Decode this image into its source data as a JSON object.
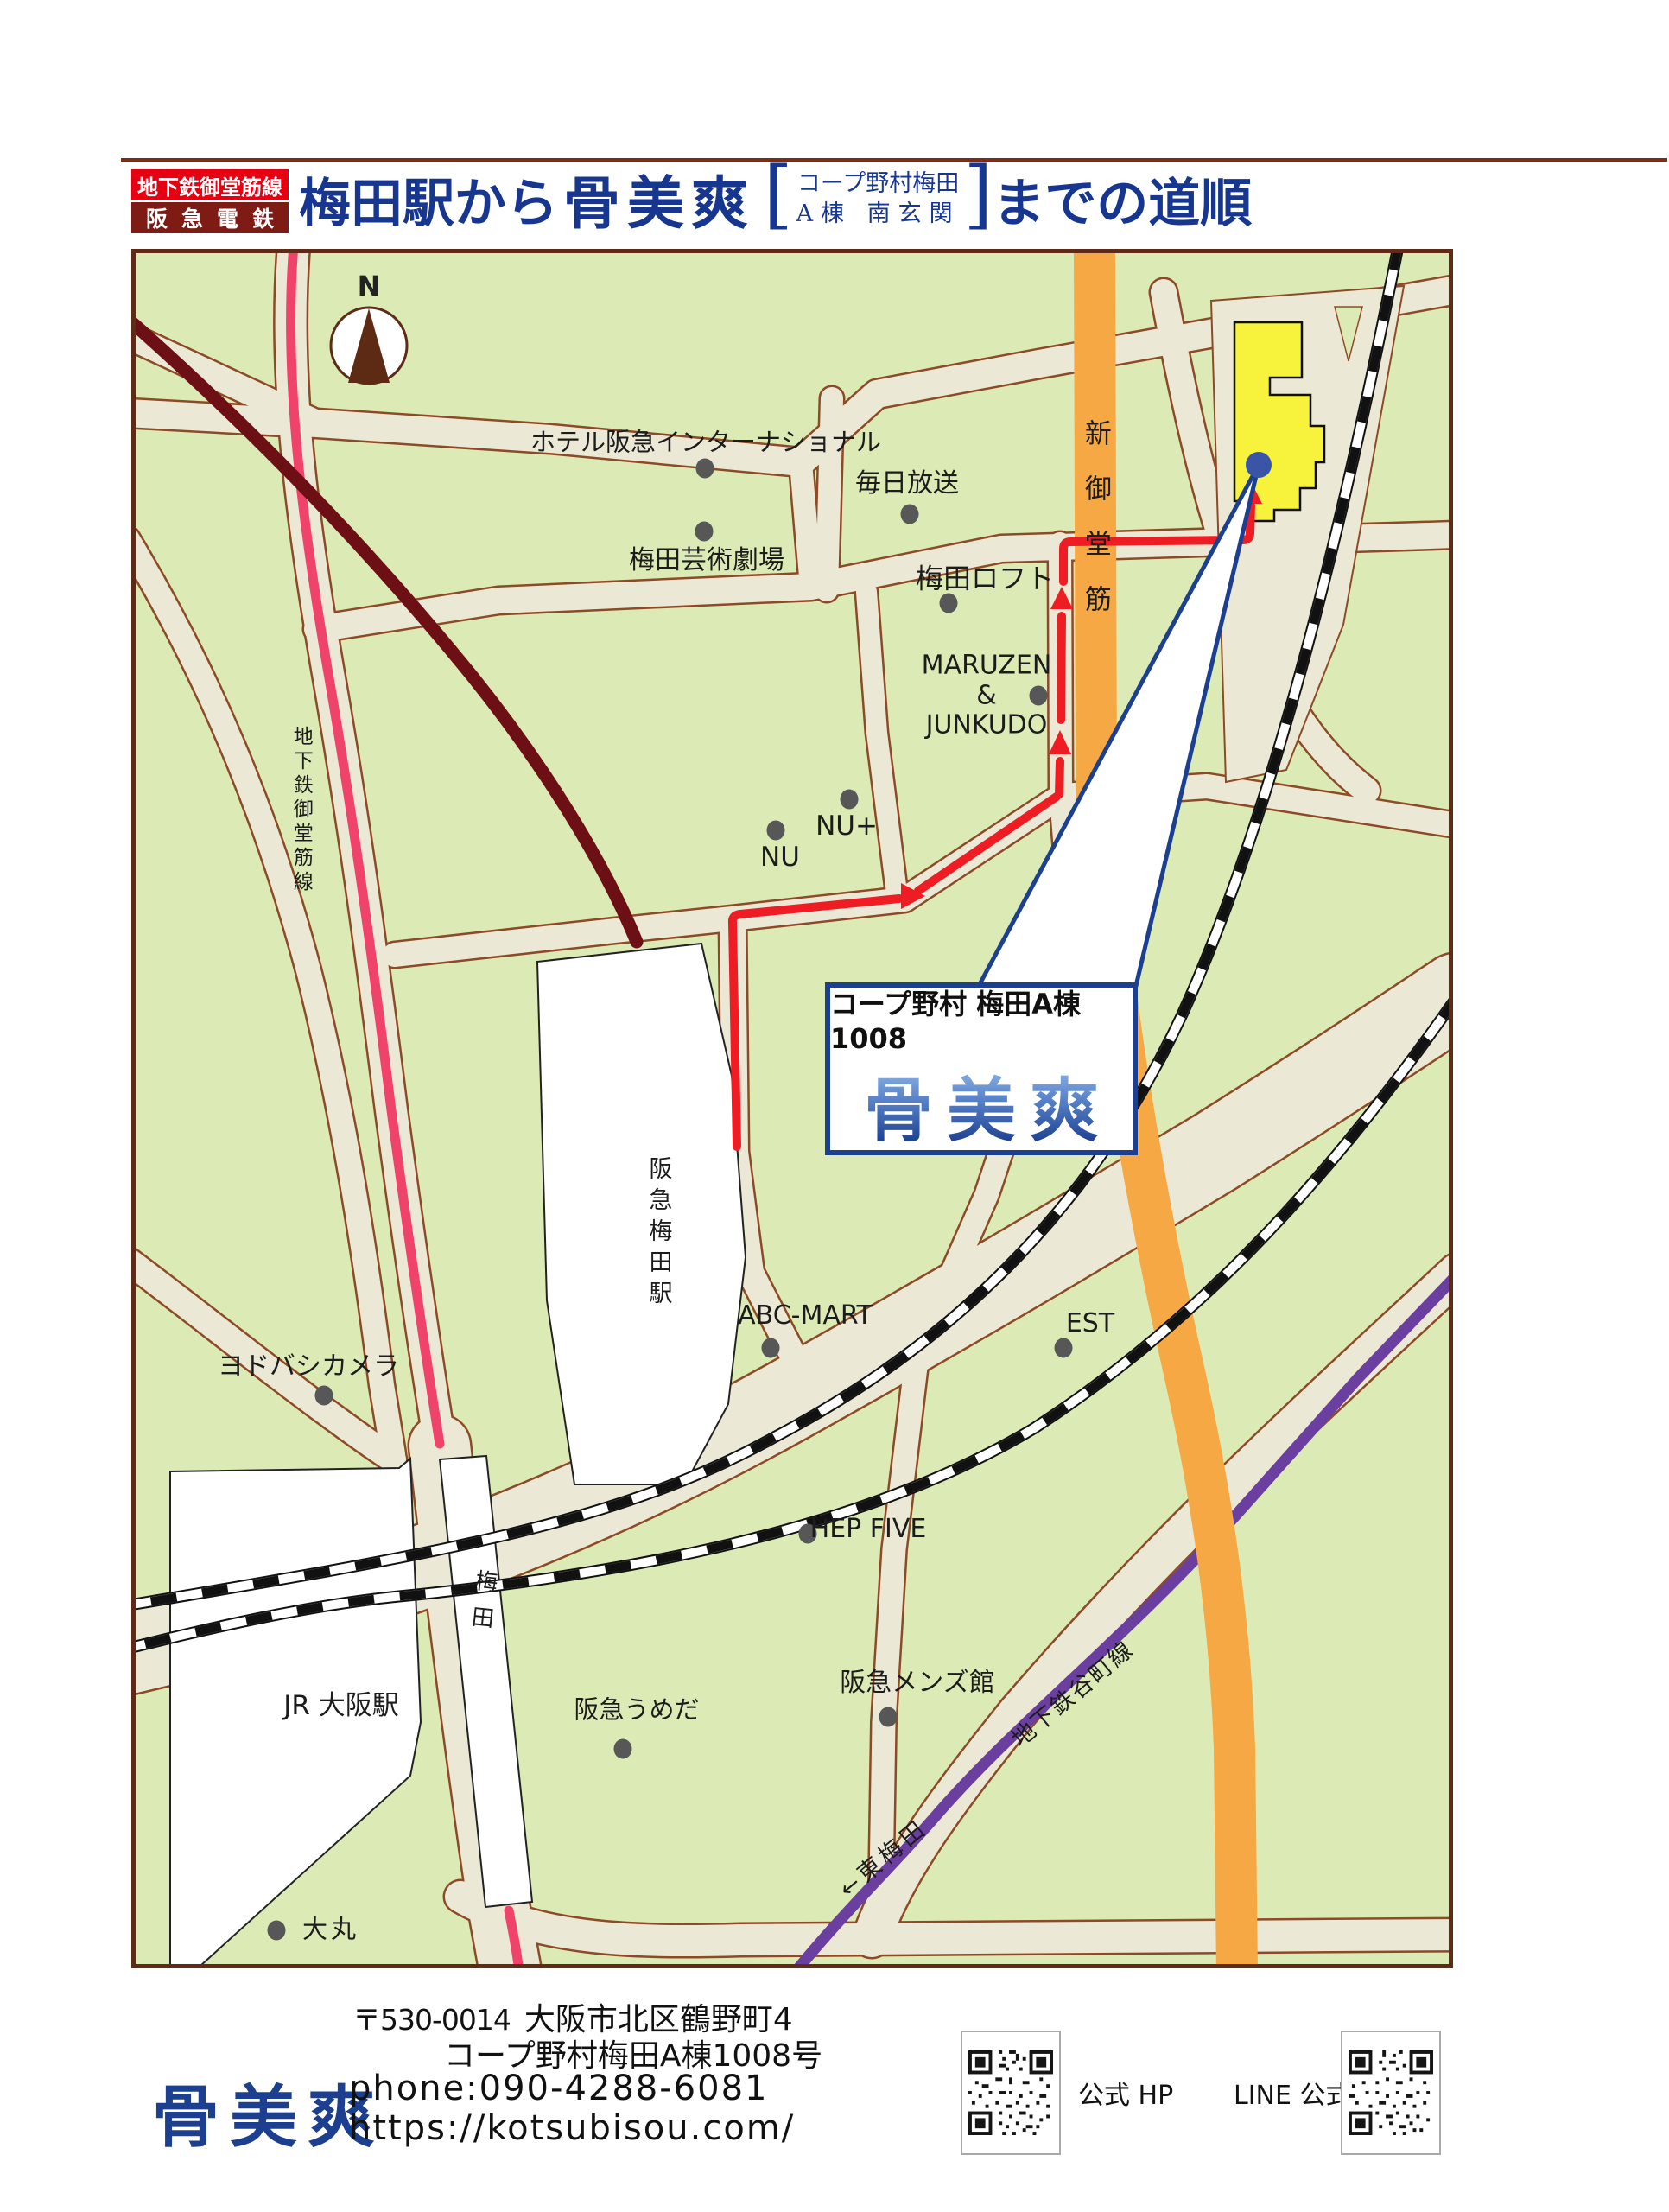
{
  "header": {
    "badge_line1": "地下鉄御堂筋線",
    "badge_line2": "阪急電鉄",
    "title_from": "梅田駅から",
    "brand": "骨美爽",
    "bracket_line1": "コープ野村梅田",
    "bracket_line2": "A棟 南玄関",
    "title_to": "までの道順"
  },
  "map": {
    "compass": "N",
    "landmarks": {
      "hotel_hankyu": "ホテル阪急インターナショナル",
      "umeda_arts": "梅田芸術劇場",
      "mainichi": "毎日放送",
      "umeda_loft": "梅田ロフト",
      "maruzen": "MARUZEN\n&\nJUNKUDO",
      "nu": "NU",
      "nu_plus": "NU+",
      "abc_mart": "ABC-MART",
      "est": "EST",
      "hep_five": "HEP FIVE",
      "hankyu_mens": "阪急メンズ館",
      "hankyu_umeda_store": "阪急うめだ",
      "yodobashi": "ヨドバシカメラ",
      "daimaru": "大丸"
    },
    "lines": {
      "midosuji_subway": "地下鉄御堂筋線",
      "shin_midosuji": "新御堂筋",
      "tanimachi_line": "地下鉄谷町線",
      "higashi_umeda": "←東梅田"
    },
    "stations": {
      "hankyu_umeda": "阪急梅田駅",
      "jr_osaka": "JR 大阪駅",
      "umeda": "梅田"
    },
    "callout": {
      "address": "コープ野村 梅田A棟1008",
      "brand": "骨美爽"
    }
  },
  "footer": {
    "logo": "骨美爽",
    "postal": "〒530-0014",
    "address_line1": "大阪市北区鶴野町4",
    "address_line2": "コープ野村梅田A棟1008号",
    "phone_label": "phone:",
    "phone_number": "090-4288-6081",
    "url": "https://kotsubisou.com/",
    "hp_qr_label": "公式 HP",
    "line_qr_label": "LINE 公式"
  }
}
